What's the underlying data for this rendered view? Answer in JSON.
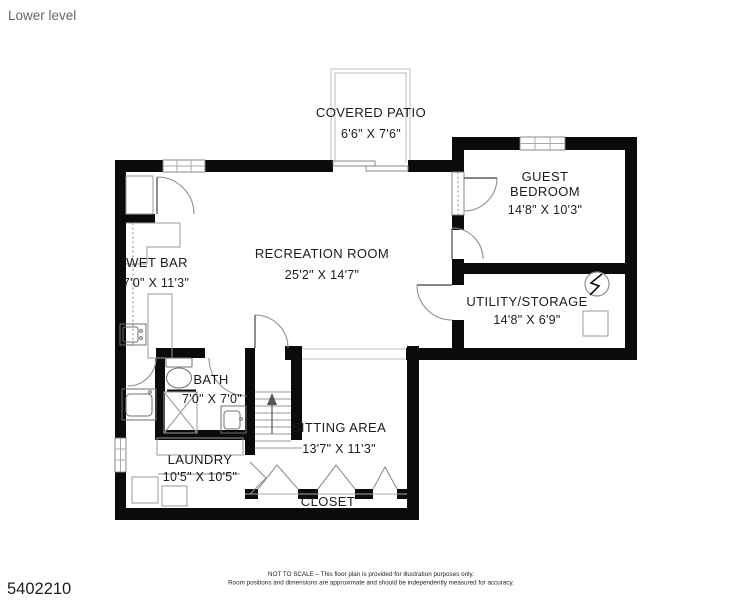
{
  "header": {
    "title": "Lower level"
  },
  "photo_id": "5402210",
  "footer": {
    "line1": "NOT TO SCALE – This floor plan is provided for illustration purposes only.",
    "line2": "Room positions and dimensions are approximate and should be independently measured for accuracy."
  },
  "rooms": {
    "covered_patio": {
      "name": "COVERED PATIO",
      "dims": "6'6\" X 7'6\""
    },
    "guest_bedroom": {
      "name_line1": "GUEST",
      "name_line2": "BEDROOM",
      "dims": "14'8\" X 10'3\""
    },
    "recreation_room": {
      "name": "RECREATION ROOM",
      "dims": "25'2\" X 14'7\""
    },
    "wet_bar": {
      "name": "WET BAR",
      "dims": "7'0\" X 11'3\""
    },
    "utility_storage": {
      "name": "UTILITY/STORAGE",
      "dims": "14'8\" X 6'9\""
    },
    "bath": {
      "name": "BATH",
      "dims": "7'0\" X 7'0\""
    },
    "sitting_area": {
      "name": "SITTING AREA",
      "dims": "13'7\" X 11'3\""
    },
    "laundry": {
      "name": "LAUNDRY",
      "dims": "10'5\" X 10'5\""
    },
    "closet": {
      "name": "CLOSET"
    }
  },
  "colors": {
    "wall": "#0b0b0b",
    "thin_line": "#a9a9a9",
    "door_arc": "#8f8f8f",
    "text": "#1c1c1c",
    "muted_text": "#666666"
  }
}
